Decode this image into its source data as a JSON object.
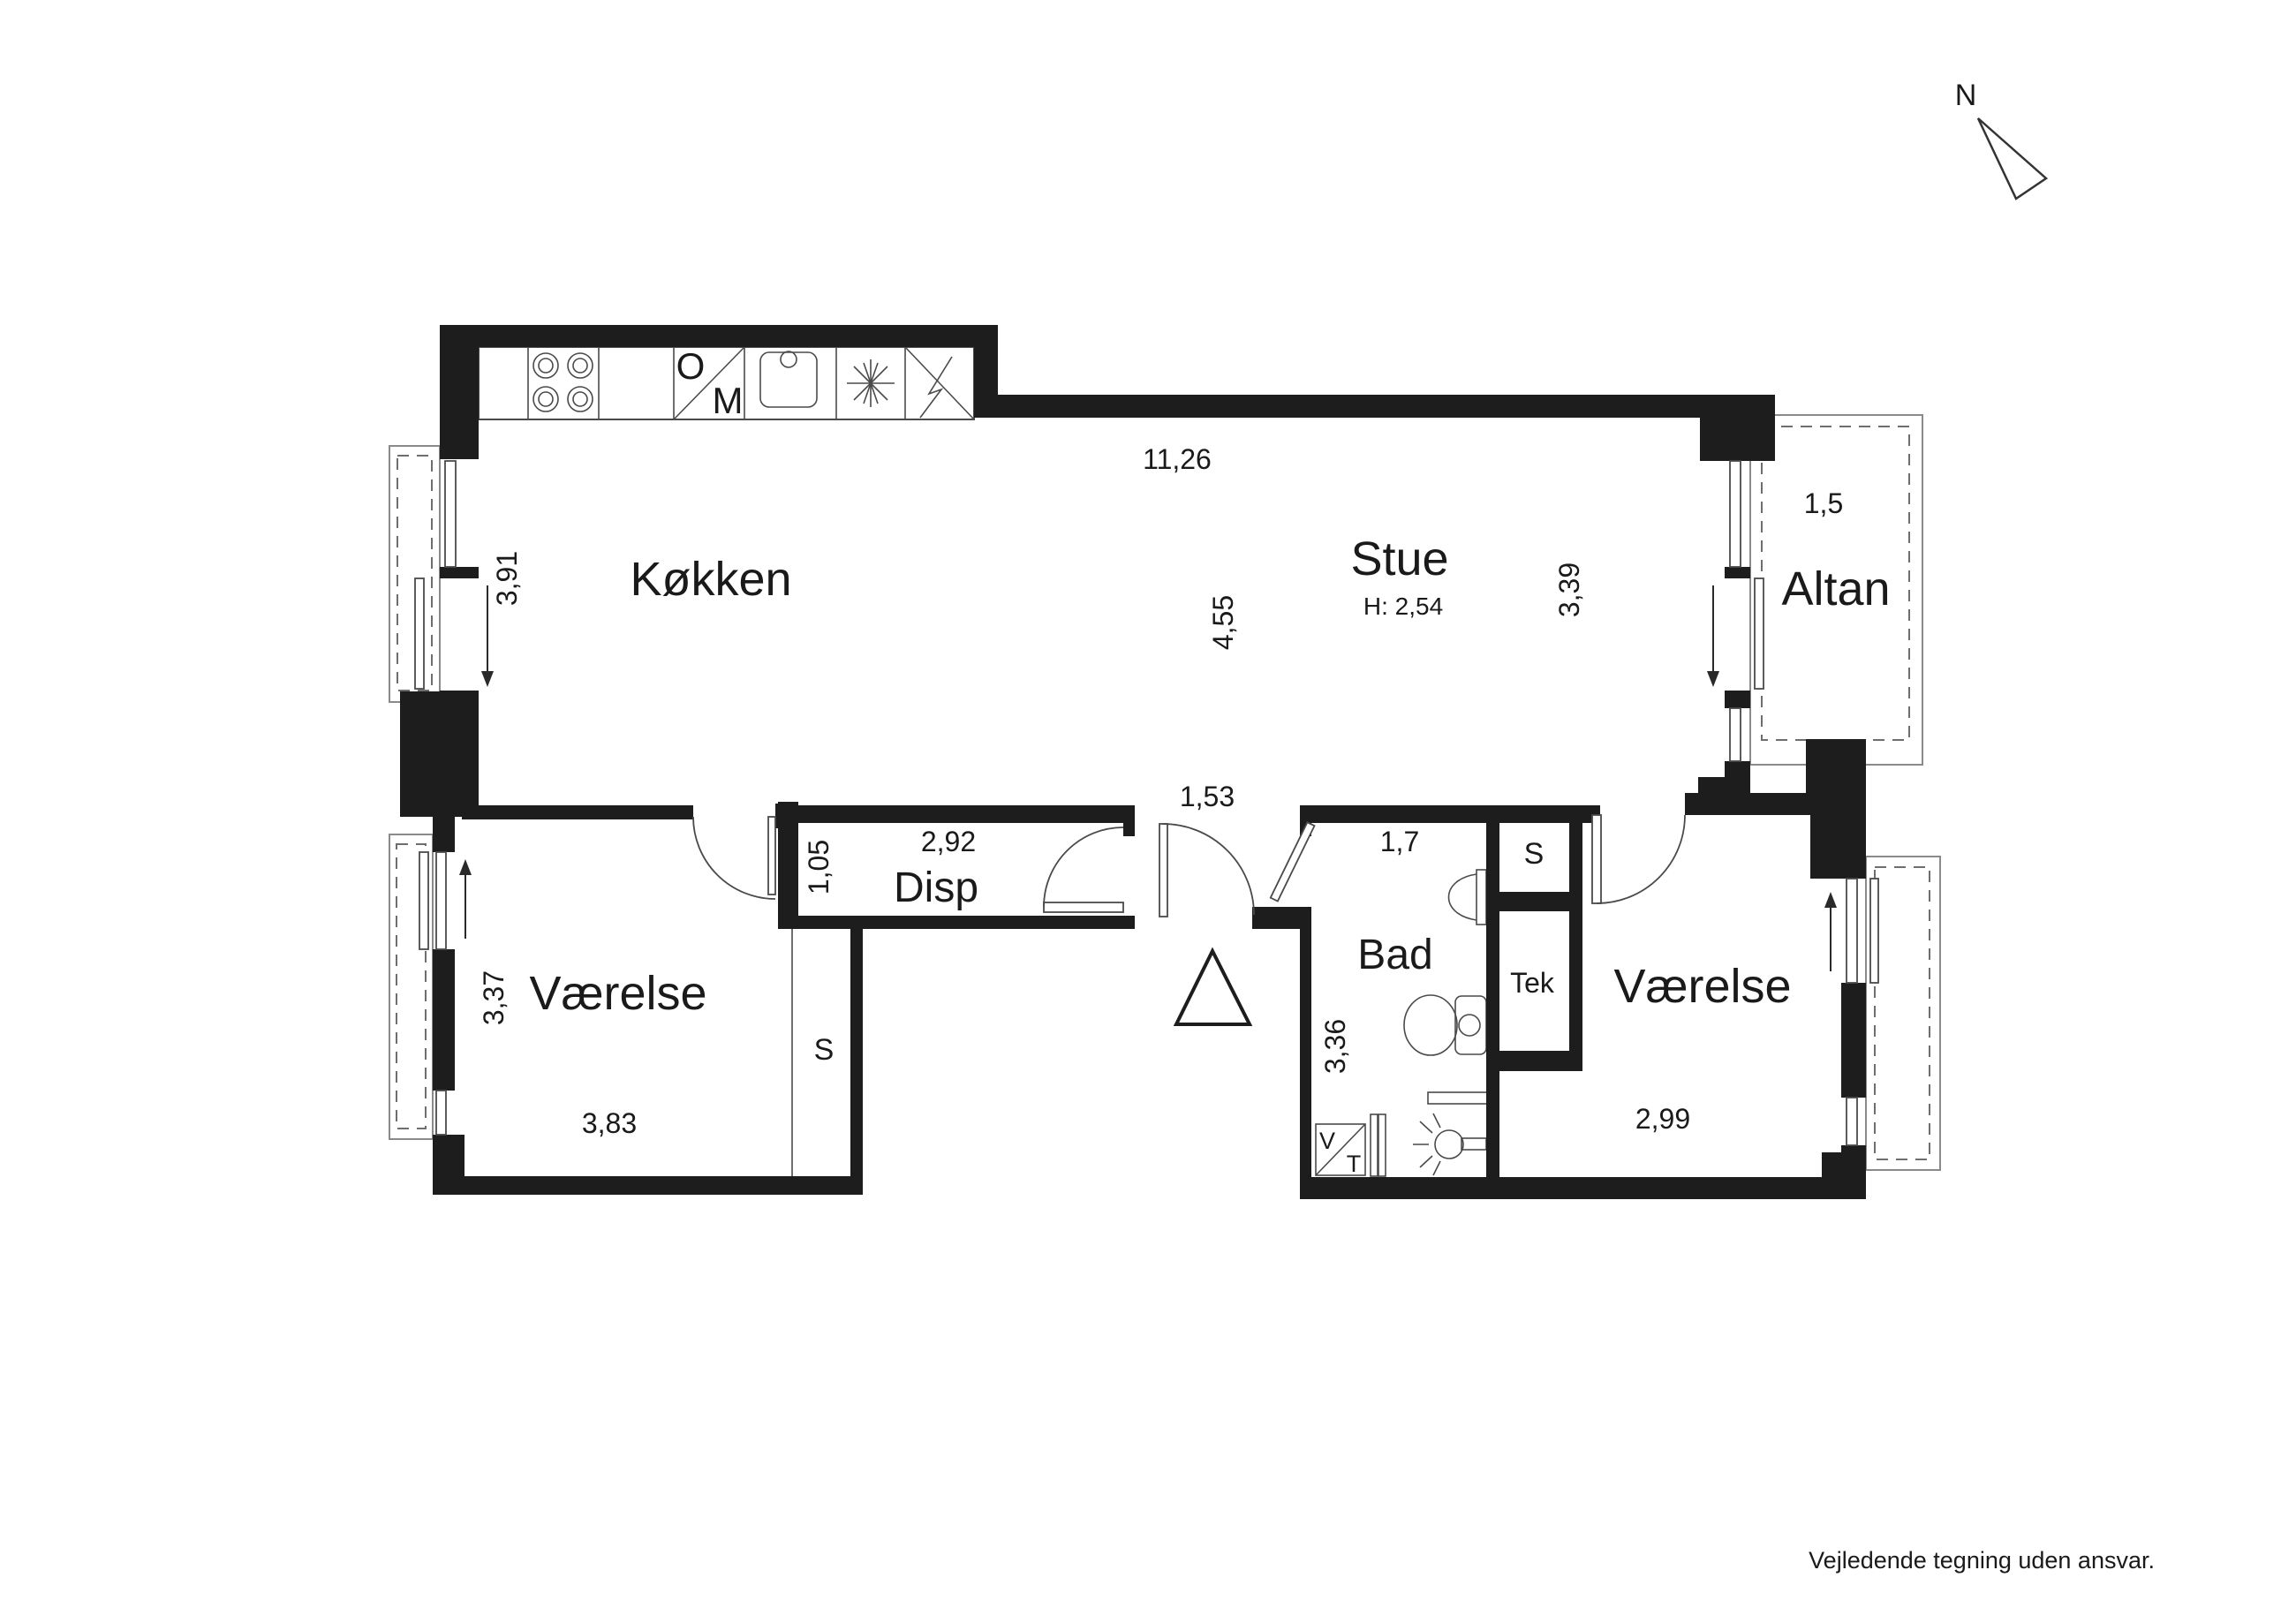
{
  "plan": {
    "type": "apartment-floor-plan",
    "language": "da",
    "disclaimer": "Vejledende tegning uden ansvar.",
    "north_label": "N",
    "wall_color": "#1d1d1d",
    "background": "#ffffff"
  },
  "labels": {
    "koekken": "Køkken",
    "stue": "Stue",
    "stue_height": "H: 2,54",
    "altan": "Altan",
    "disp": "Disp",
    "bad": "Bad",
    "tek": "Tek",
    "vaerelse_left": "Værelse",
    "vaerelse_right": "Værelse",
    "closet_left": "S",
    "closet_right": "S",
    "oven": "O",
    "microwave": "M",
    "washer": "V",
    "dryer": "T",
    "north": "N",
    "disclaimer": "Vejledende tegning uden ansvar."
  },
  "dims": {
    "top_width": "11,26",
    "kitchen_depth": "3,91",
    "stue_width": "4,55",
    "stue_depth": "3,39",
    "altan_depth": "1,5",
    "hall_opening": "1,53",
    "disp_width": "2,92",
    "disp_depth": "1,05",
    "bad_width": "1,7",
    "bad_depth": "3,36",
    "room_left_depth": "3,37",
    "room_left_width": "3,83",
    "room_right_width": "2,99"
  }
}
